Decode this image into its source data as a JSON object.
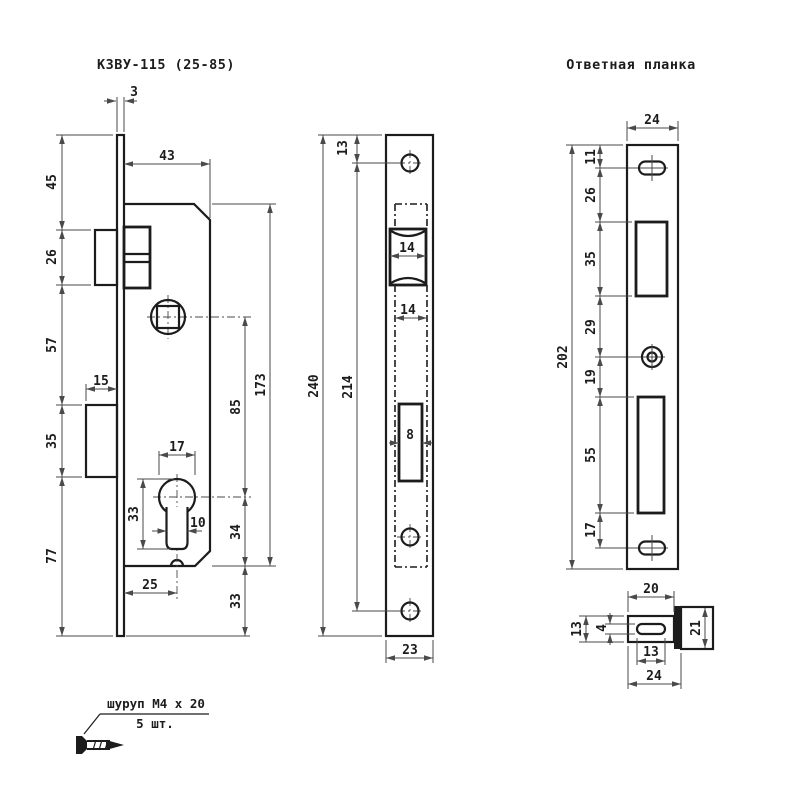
{
  "titles": {
    "lock": "КЗВУ-115 (25-85)",
    "strike": "Ответная планка"
  },
  "note": {
    "line1": "шуруп М4 х 20",
    "line2": "5 шт."
  },
  "side": {
    "faceplate_thk": "3",
    "body_depth": "43",
    "top_to_latch": "45",
    "latch_h": "26",
    "latch_to_bolt": "57",
    "bolt_h": "35",
    "bolt_to_bottom": "77",
    "bolt_protrusion": "15",
    "cyl_dia": "17",
    "cyl_h": "33",
    "cyl_neck": "10",
    "backset": "25",
    "centers": "85",
    "body_h": "173",
    "cyl_to_body_bottom": "34",
    "body_to_plate_bottom": "33"
  },
  "front": {
    "top_to_screw": "13",
    "plate_len": "240",
    "screw_centers": "214",
    "latch_w": "14",
    "body_w": "14",
    "bolt_slot_w": "8",
    "plate_w": "23"
  },
  "strike": {
    "plate_w": "24",
    "top_to_hole": "11",
    "hole_to_latch": "26",
    "latch_open_h": "35",
    "latch_to_screw": "29",
    "screw_to_bolt": "19",
    "bolt_open_h": "55",
    "bolt_to_hole": "17",
    "plate_len": "202"
  },
  "section": {
    "flat_w": "20",
    "flat_h": "13",
    "slot_w": "4",
    "slot_len": "13",
    "total_w": "24",
    "lip_depth": "21"
  }
}
